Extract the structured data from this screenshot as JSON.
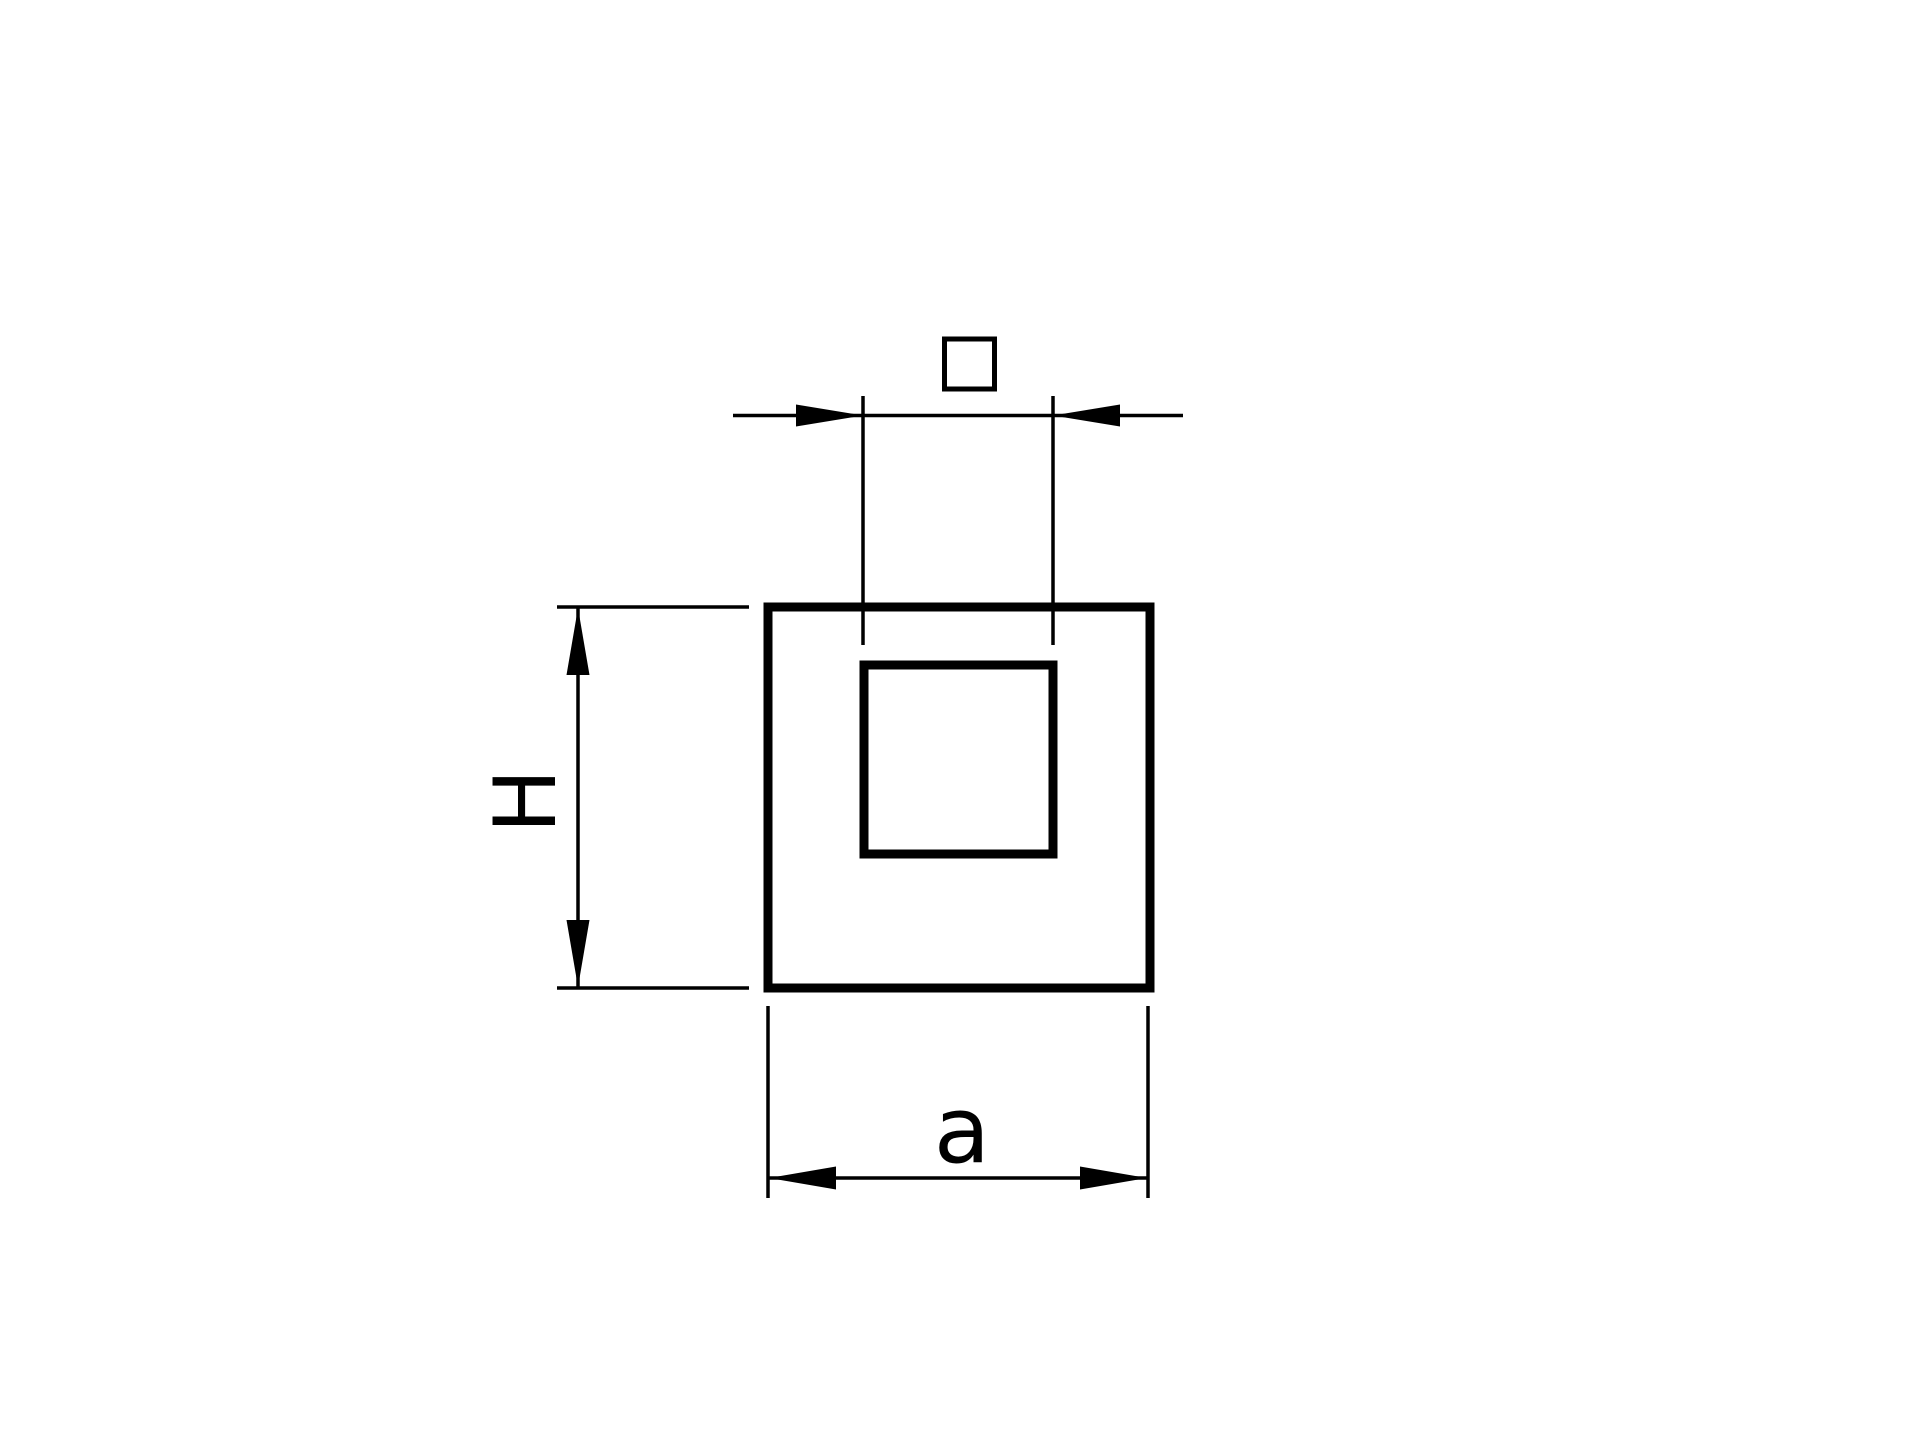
{
  "theme": {
    "background_color": "#ffffff",
    "line_color": "#000000"
  },
  "drawing": {
    "labels": {
      "height": "H",
      "width": "a",
      "square_symbol": "□"
    }
  }
}
